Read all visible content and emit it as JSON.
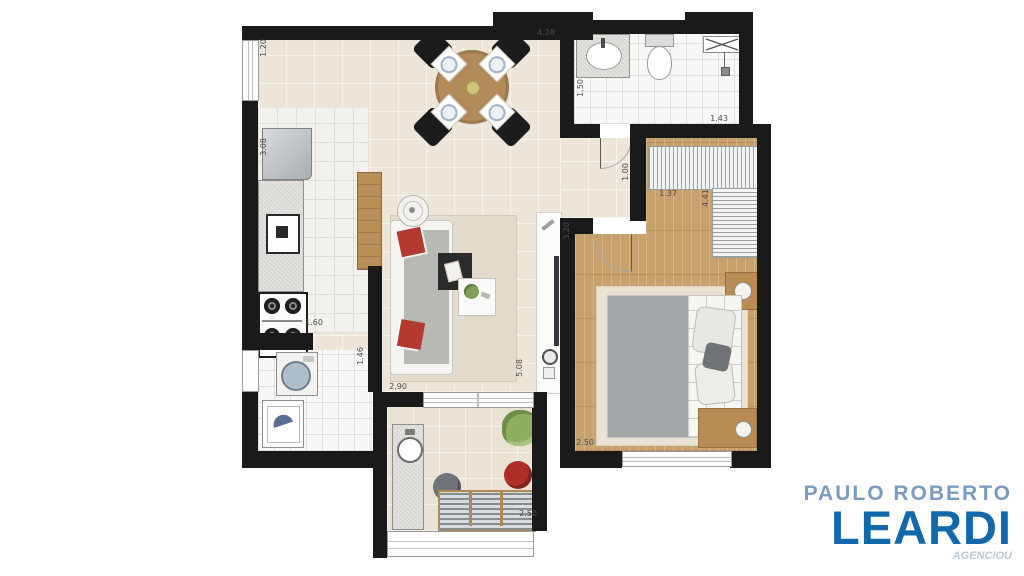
{
  "branding": {
    "line1": "PAULO ROBERTO",
    "line2": "LEARDI",
    "watermark": "AGENCIOU",
    "line1_color": "#7b9bc1",
    "line2_color": "#1168aa"
  },
  "plan": {
    "wall_color": "#1a1a1a",
    "wood_color": "#c7a06b",
    "accent_red": "#b23a30",
    "dimensions": {
      "dining": "4.28",
      "left_window": "1.20",
      "bath_depth": "1.50",
      "bath_width": "1.43",
      "hall_width": "1.00",
      "bedroom_nook": "1.37",
      "wardrobe_wall": "4.41",
      "bedroom_length": "3.20",
      "bedroom_width": "2.50",
      "kitchen_depth": "3.08",
      "stove_width": "1.60",
      "kitchen_pass": "1.46",
      "living_width": "2.90",
      "living_length": "5.08",
      "balcony_width": "2.50"
    }
  }
}
